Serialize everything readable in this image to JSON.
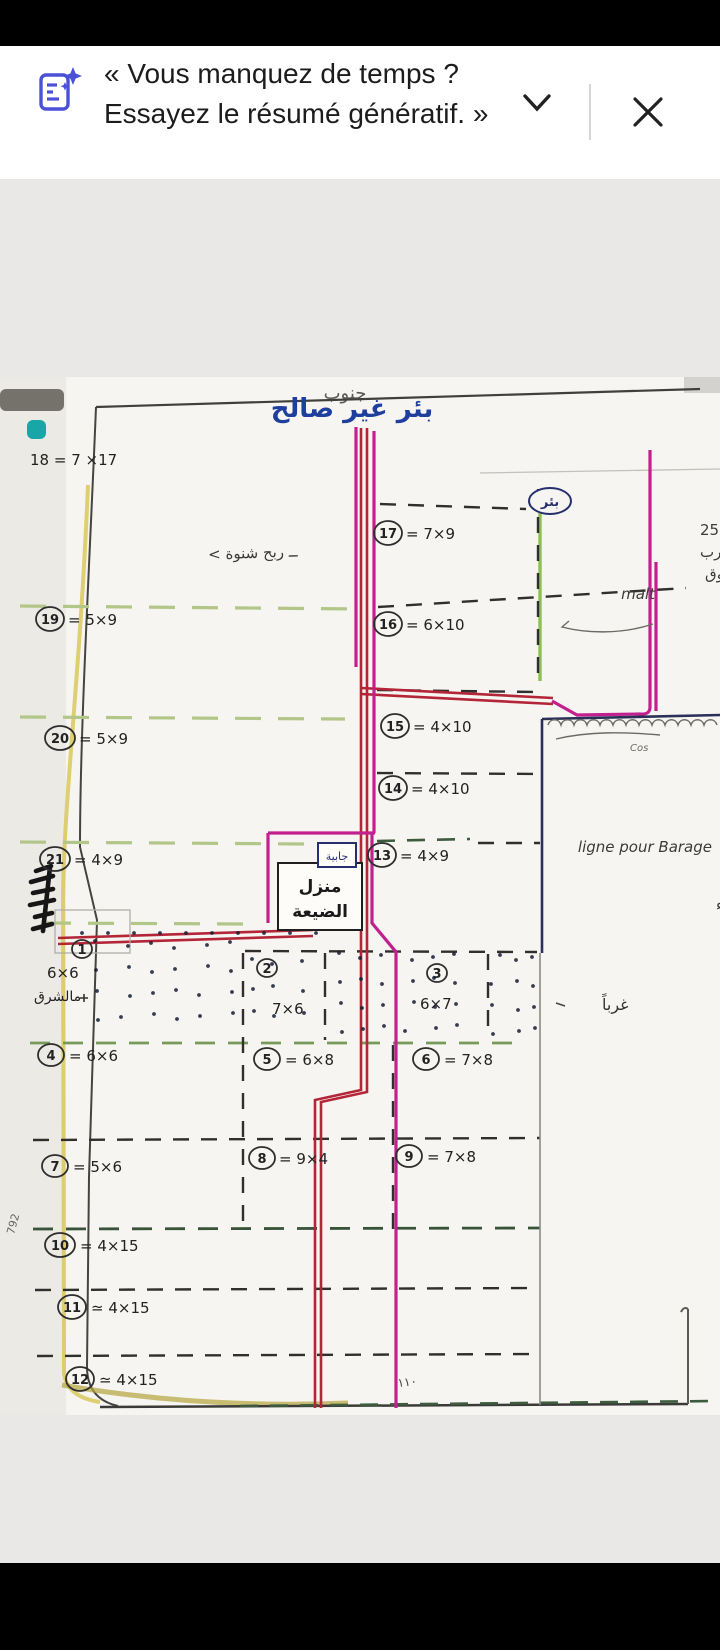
{
  "banner": {
    "line1": "« Vous manquez de temps ?",
    "line2": "Essayez le résumé génératif. »",
    "accent_color": "#4b51d6"
  },
  "doc": {
    "heading_cut": "جنوب",
    "title": "بئر غير صالح",
    "well_badge": "بئر",
    "area_note": "ــ ربح شنوة >",
    "notes_top_right": {
      "l1": "ربح كبير = 12×25",
      "l2": "يحتوي على ما يقارب",
      "l3": "عن 50 شجرة من يفوق",
      "l4": "malt"
    },
    "edge_note_cut": "بلايك",
    "cos_note": "Cos",
    "notes_right": {
      "l1": "طرفة",
      "l2": "ممرّ",
      "l3": "رند",
      "l4": "طريق رئيسيّة",
      "l5": "ligne pour Barage",
      "l6": "حائط",
      "l7": "توزيع الماء"
    },
    "west_label": "غرباً",
    "left_edge_note": "مالشرق",
    "left_margin_num": "792",
    "bottom_note": "١١٠",
    "tank_label": "جابية",
    "house": {
      "l1": "منزل",
      "l2": "الضيعة"
    },
    "plots": {
      "p18": {
        "text": "18 = 7 ×17"
      },
      "p17": {
        "num": "17",
        "dims": "= 7×9"
      },
      "p19": {
        "num": "19",
        "dims": "= 5×9"
      },
      "p16": {
        "num": "16",
        "dims": "= 6×10"
      },
      "p20": {
        "num": "20",
        "dims": "= 5×9"
      },
      "p15": {
        "num": "15",
        "dims": "= 4×10"
      },
      "p14": {
        "num": "14",
        "dims": "= 4×10"
      },
      "p21": {
        "num": "21",
        "dims": "= 4×9"
      },
      "p13": {
        "num": "13",
        "dims": "= 4×9"
      },
      "p1": {
        "num": "1",
        "dims": "6×6"
      },
      "p2": {
        "num": "2",
        "dims": "7×6"
      },
      "p3": {
        "num": "3",
        "dims": "6×7"
      },
      "p4": {
        "num": "4",
        "dims": "= 6×6"
      },
      "p5": {
        "num": "5",
        "dims": "= 6×8"
      },
      "p6": {
        "num": "6",
        "dims": "= 7×8"
      },
      "p7": {
        "num": "7",
        "dims": "= 5×6"
      },
      "p8": {
        "num": "8",
        "dims": "= 9×4"
      },
      "p9": {
        "num": "9",
        "dims": "= 7×8"
      },
      "p10": {
        "num": "10",
        "dims": "= 4×15"
      },
      "p11": {
        "num": "11",
        "dims": "≃ 4×15"
      },
      "p12": {
        "num": "12",
        "dims": "≃ 4×15"
      }
    }
  }
}
